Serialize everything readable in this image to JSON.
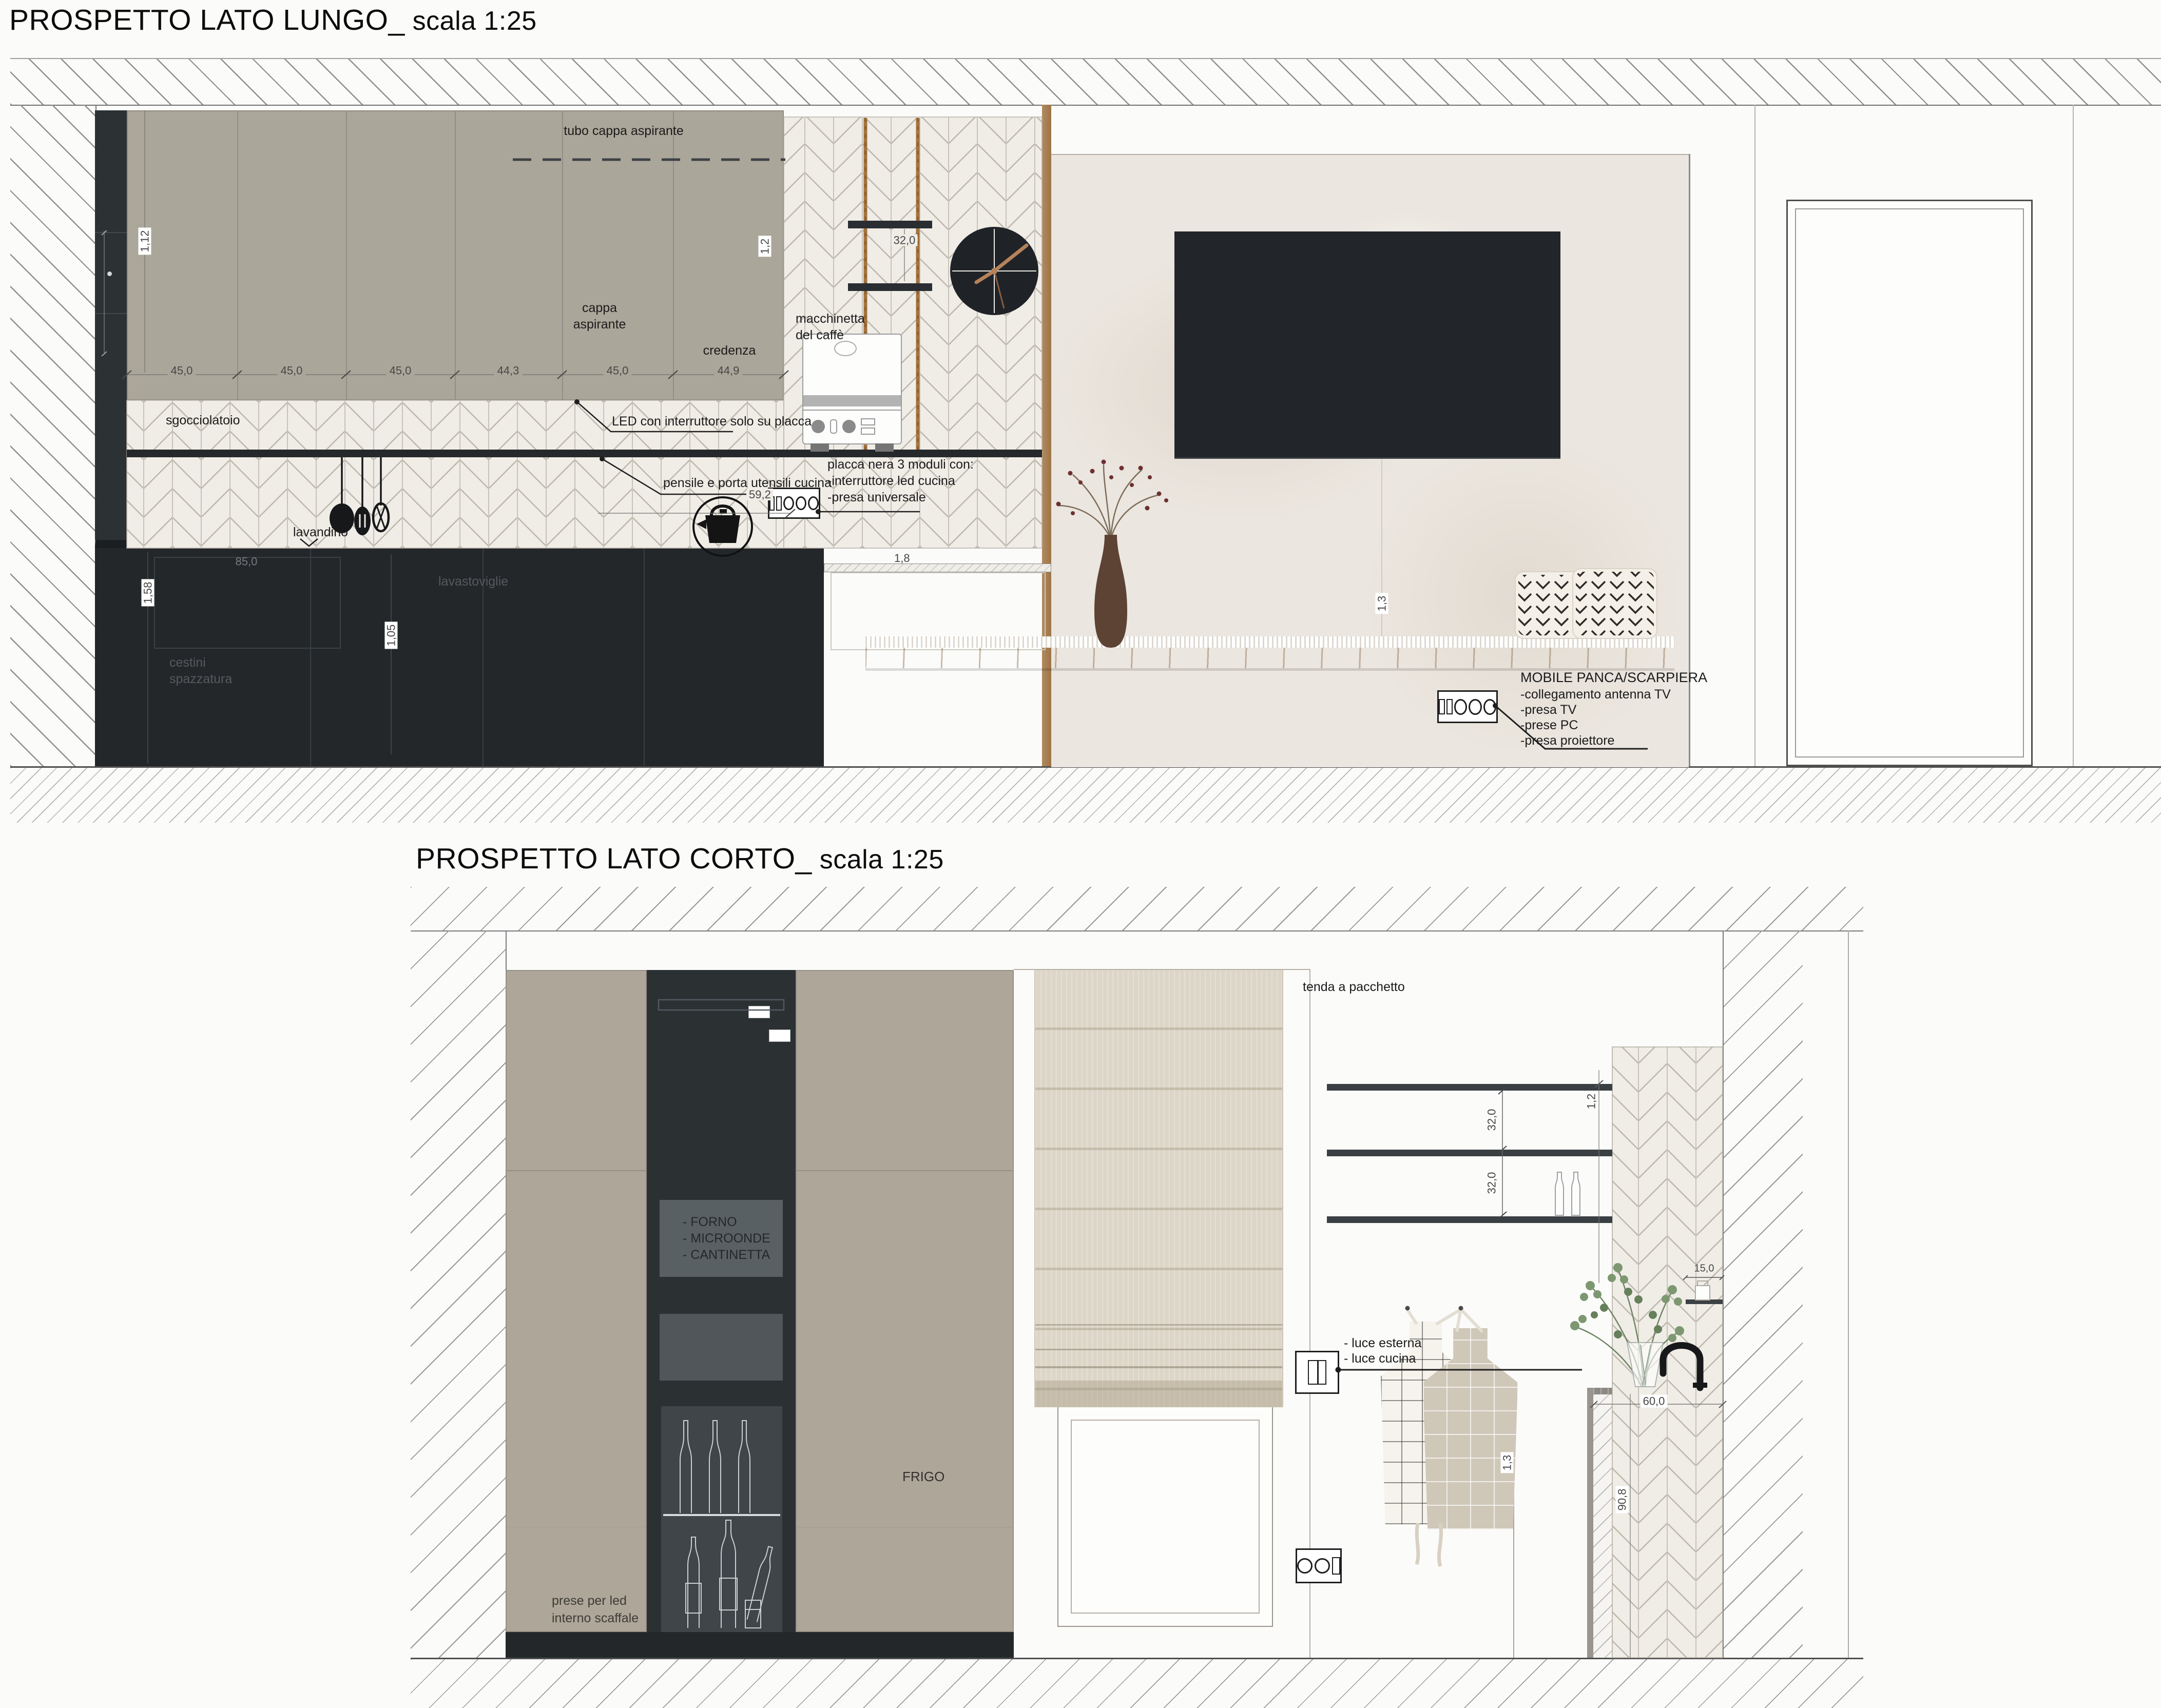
{
  "accent_colors": {
    "cabinet_taupe": "#aba69a",
    "cabinet_dark": "#23272a",
    "tile_bg": "#f0ede7",
    "plaster": "#ebe6df",
    "wood": "#b08a5c",
    "copper": "#b5825a"
  },
  "d1": {
    "title": "PROSPETTO LATO LUNGO_",
    "scale": " scala 1:25",
    "labels": {
      "tubo": "tubo cappa aspirante",
      "cappa1": "cappa",
      "cappa2": "aspirante",
      "credenza": "credenza",
      "sgocciolatoio": "sgocciolatoio",
      "led": "LED con interruttore solo su placca",
      "pensile": "pensile e porta utensili cucina",
      "macchinetta1": "macchinetta",
      "macchinetta2": "del caffè",
      "placca1": "placca nera 3 moduli con:",
      "placca2": "-interruttore led cucina",
      "placca3": "-presa universale",
      "lavandino": "lavandino",
      "lavastoviglie": "lavastoviglie",
      "cestini1": "cestini",
      "cestini2": "spazzatura",
      "mobile1": "MOBILE PANCA/SCARPIERA",
      "mobile2": "-collegamento antenna TV",
      "mobile3": "-presa TV",
      "mobile4": "-prese PC",
      "mobile5": "-presa proiettore"
    },
    "dims": {
      "m1": "45,0",
      "m2": "45,0",
      "m3": "45,0",
      "m4": "44,3",
      "m5": "45,0",
      "m6": "44,9",
      "upper_h": "1,12",
      "right_h": "1,2",
      "rope": "32,0",
      "depth": "59,2",
      "bench": "1,8",
      "drawer": "85,0",
      "base_h": "1,58",
      "base_h2": "1,05",
      "wall_h": "1,3"
    }
  },
  "d2": {
    "title": "PROSPETTO LATO CORTO_",
    "scale": " scala 1:25",
    "labels": {
      "forno": "- FORNO",
      "microonde": "- MICROONDE",
      "cantinetta": "- CANTINETTA",
      "frigo": "FRIGO",
      "prese1": "prese per led",
      "prese2": "interno scaffale",
      "tenda": "tenda a pacchetto",
      "luce1": "- luce esterna",
      "luce2": "- luce cucina"
    },
    "dims": {
      "s1": "32,0",
      "s2": "32,0",
      "sr": "1,2",
      "niche": "15,0",
      "sink": "60,0",
      "counter_h": "90,8",
      "switch_h": "1,3"
    }
  }
}
